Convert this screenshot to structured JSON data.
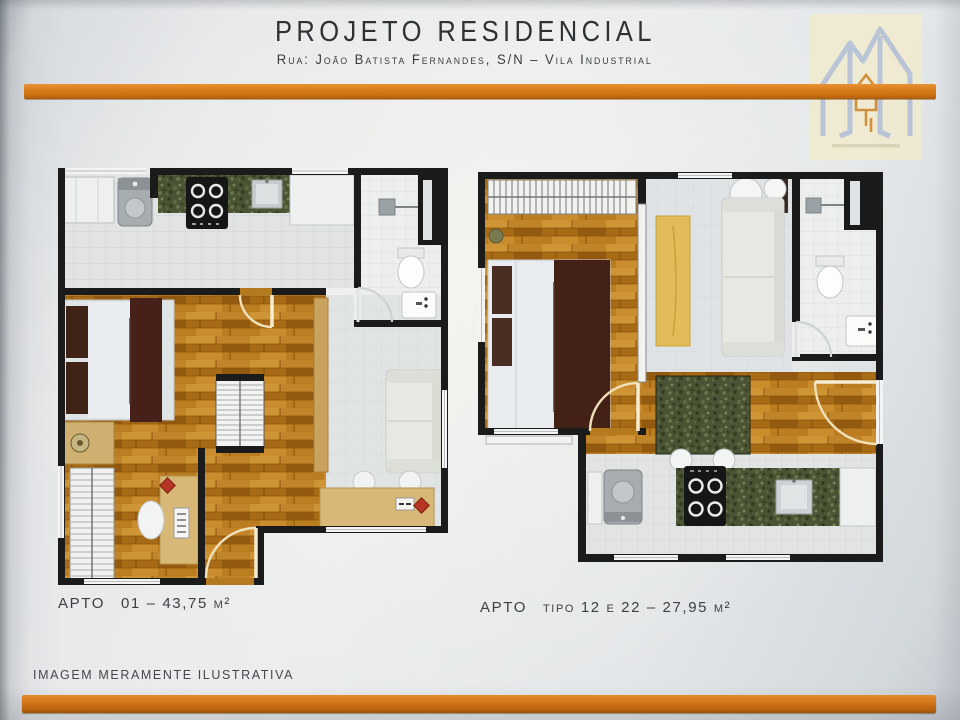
{
  "header": {
    "title": "PROJETO RESIDENCIAL",
    "subtitle": "Rua: João Batista Fernandes, S/N – Vila Industrial"
  },
  "plans": [
    {
      "id": "apto-01",
      "label_prefix": "APTO",
      "label_detail": "01 – 43,75 m²"
    },
    {
      "id": "apto-tipo-12-22",
      "label_prefix": "APTO",
      "label_detail": "tipo 12 e 22 – 27,95 m²"
    }
  ],
  "footer": {
    "disclaimer": "IMAGEM MERAMENTE ILUSTRATIVA"
  },
  "logo": {
    "icon": "house-m-logo"
  },
  "colors": {
    "accent_orange": "#D9821F",
    "wall_black": "#1B1B1B",
    "wood_floor": "#B5791E",
    "granite_green": "#4A5434",
    "paper": "#E7E9EB"
  }
}
